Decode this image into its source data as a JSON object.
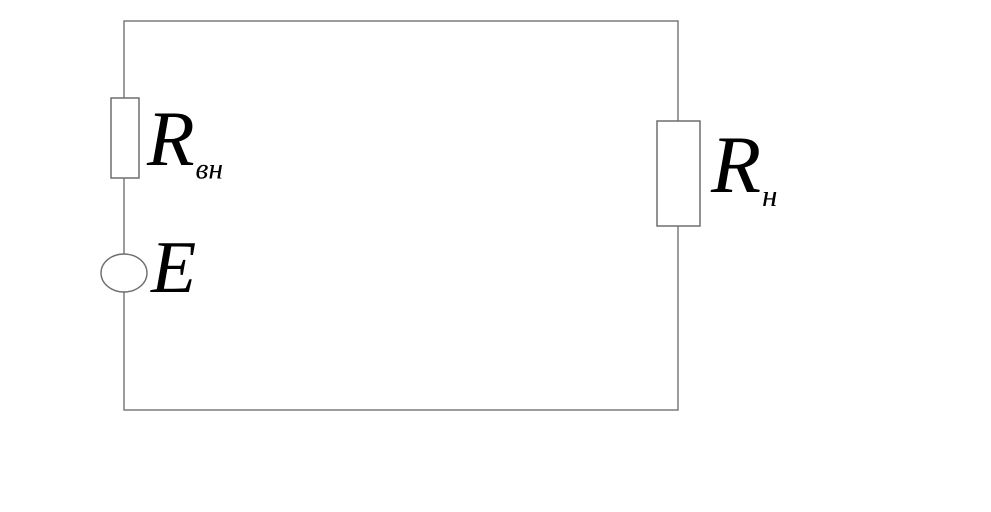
{
  "colors": {
    "background": "#ffffff",
    "wire": "#7b7b7b",
    "component_outline": "#6f6f6f",
    "label_text": "#000000"
  },
  "labels": {
    "internal_resistance": {
      "base": "R",
      "subscript": "вн"
    },
    "emf": {
      "base": "E"
    },
    "load_resistance": {
      "base": "R",
      "subscript": "н"
    }
  }
}
